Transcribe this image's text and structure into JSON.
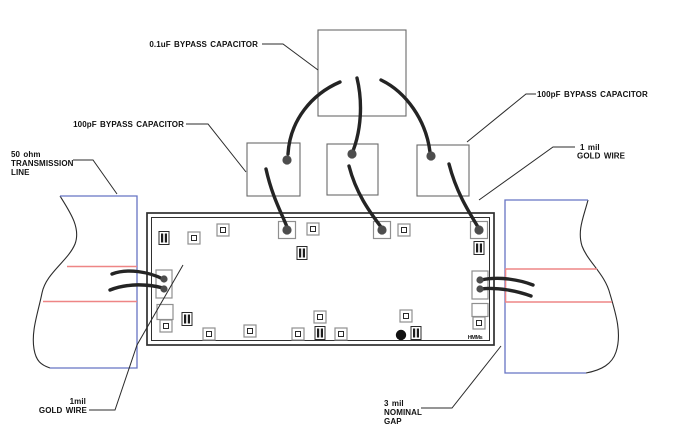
{
  "labels": {
    "cap01uf": "0.1uF BYPASS CAPACITOR",
    "cap100pf_left": "100pF BYPASS CAPACITOR",
    "cap100pf_right": "100pF BYPASS CAPACITOR",
    "goldwire_tr_1": "1 mil",
    "goldwire_tr_2": "GOLD WIRE",
    "txline_1": "50 ohm",
    "txline_2": "TRANSMISSION",
    "txline_3": "LINE",
    "goldwire_bl_1": "1mil",
    "goldwire_bl_2": "GOLD WIRE",
    "gap_1": "3 mil",
    "gap_2": "NOMINAL",
    "gap_3": "GAP",
    "marking": "HMMs"
  },
  "colors": {
    "outline": "#2b2b2b",
    "substrate_blue": "#6674c4",
    "trace_red": "#ee8585",
    "pad_gray": "#8f8f8f",
    "wire_black": "#242424",
    "ball_gray": "#4d4d4d"
  },
  "board": {
    "pads": [
      {
        "t": "chip",
        "x": 164,
        "y": 238
      },
      {
        "t": "pad",
        "x": 194,
        "y": 238
      },
      {
        "t": "pad",
        "x": 223,
        "y": 230
      },
      {
        "t": "bond",
        "x": 287,
        "y": 230
      },
      {
        "t": "pad",
        "x": 313,
        "y": 229
      },
      {
        "t": "chip",
        "x": 302,
        "y": 253
      },
      {
        "t": "bond",
        "x": 382,
        "y": 230
      },
      {
        "t": "pad",
        "x": 404,
        "y": 230
      },
      {
        "t": "bond",
        "x": 479,
        "y": 230
      },
      {
        "t": "chip",
        "x": 479,
        "y": 248
      },
      {
        "t": "bond2",
        "x": 164,
        "y": 284
      },
      {
        "t": "bond2",
        "x": 480,
        "y": 285
      },
      {
        "t": "square",
        "x": 165,
        "y": 312,
        "h": 15
      },
      {
        "t": "pad",
        "x": 166,
        "y": 326
      },
      {
        "t": "chip",
        "x": 187,
        "y": 319
      },
      {
        "t": "pad",
        "x": 209,
        "y": 334
      },
      {
        "t": "pad",
        "x": 250,
        "y": 331
      },
      {
        "t": "pad",
        "x": 298,
        "y": 334
      },
      {
        "t": "chip",
        "x": 320,
        "y": 333
      },
      {
        "t": "pad",
        "x": 341,
        "y": 334
      },
      {
        "t": "pad",
        "x": 320,
        "y": 317
      },
      {
        "t": "pad",
        "x": 406,
        "y": 316
      },
      {
        "t": "dot",
        "x": 401,
        "y": 335
      },
      {
        "t": "chip",
        "x": 416,
        "y": 333
      },
      {
        "t": "square",
        "x": 480,
        "y": 310,
        "h": 13
      },
      {
        "t": "pad",
        "x": 479,
        "y": 323
      }
    ],
    "balls": [
      {
        "x": 287,
        "y": 160,
        "r": 4.6
      },
      {
        "x": 352,
        "y": 154,
        "r": 4.6
      },
      {
        "x": 431,
        "y": 156,
        "r": 4.6
      },
      {
        "x": 287,
        "y": 230,
        "r": 4.6
      },
      {
        "x": 382,
        "y": 230,
        "r": 4.6
      },
      {
        "x": 479,
        "y": 230,
        "r": 4.6
      },
      {
        "x": 164,
        "y": 279,
        "r": 3.6
      },
      {
        "x": 164,
        "y": 289,
        "r": 3.6
      },
      {
        "x": 480,
        "y": 280,
        "r": 3.6
      },
      {
        "x": 480,
        "y": 289,
        "r": 3.6
      }
    ]
  }
}
